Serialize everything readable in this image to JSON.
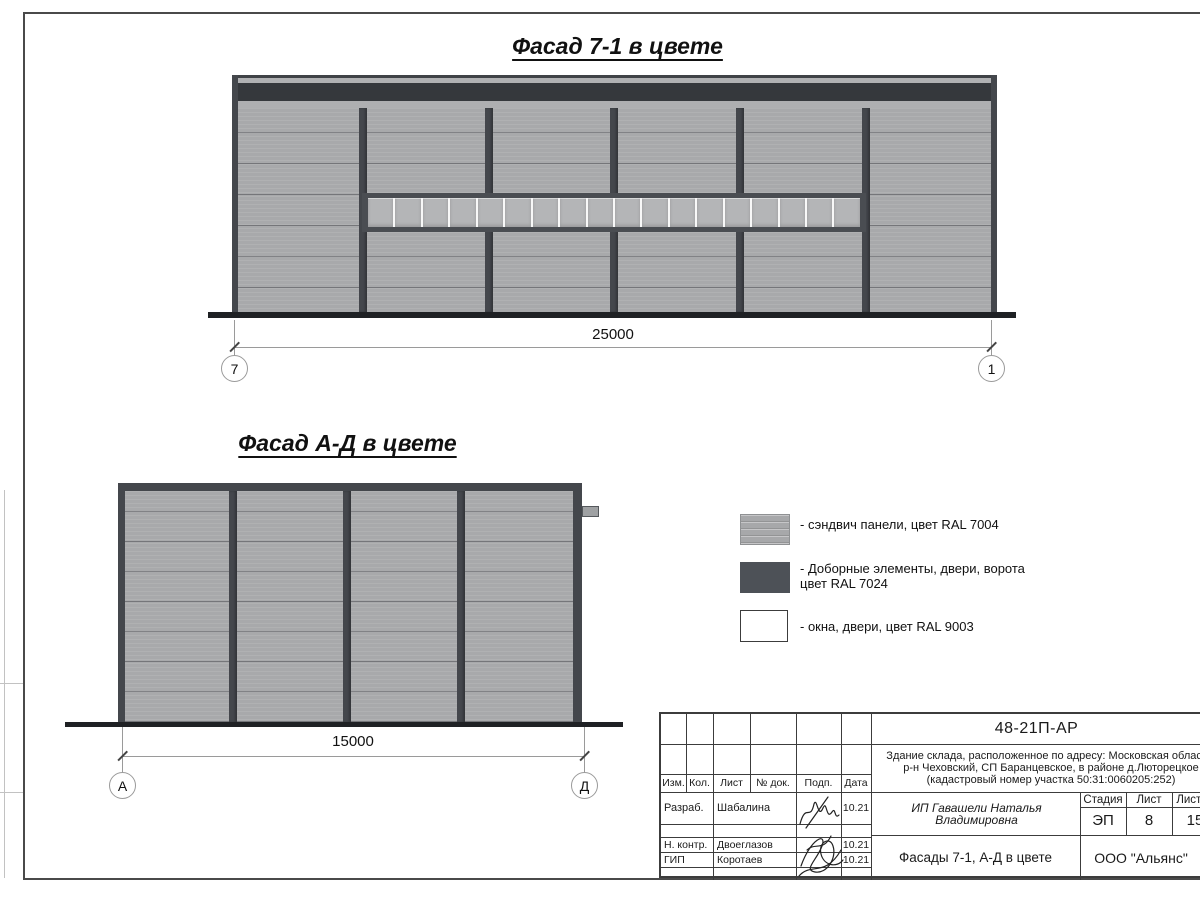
{
  "titles": {
    "facade_7_1": "Фасад 7-1 в цвете",
    "facade_ad": "Фасад А-Д в цвете"
  },
  "facade_7_1": {
    "dimension": "25000",
    "axis_left": "7",
    "axis_right": "1",
    "window_panes": 18
  },
  "facade_ad": {
    "dimension": "15000",
    "axis_left": "А",
    "axis_right": "Д"
  },
  "legend": {
    "items": [
      {
        "name": "sandwich-panels",
        "line1": "- сэндвич панели, цвет RAL 7004",
        "line2": ""
      },
      {
        "name": "trim-elements",
        "line1": "- Доборные элементы, двери, ворота",
        "line2": "цвет RAL 7024"
      },
      {
        "name": "windows-doors",
        "line1": "- окна, двери, цвет RAL 9003",
        "line2": ""
      }
    ]
  },
  "title_block": {
    "doc_number": "48-21П-АР",
    "project_line1": "Здание склада, расположенное по адресу: Московская область,",
    "project_line2": "р-н Чеховский, СП Баранцевское, в районе д.Люторецкое",
    "project_line3": "(кадастровый номер участка 50:31:0060205:252)",
    "header_cells": [
      "Изм.",
      "Кол.",
      "Лист",
      "№ док.",
      "Подп.",
      "Дата"
    ],
    "rows": [
      {
        "role": "Разраб.",
        "name": "Шабалина",
        "date": "10.21"
      },
      {
        "role": "Н. контр.",
        "name": "Двоеглазов",
        "date": "10.21"
      },
      {
        "role": "ГИП",
        "name": "Коротаев",
        "date": "10.21"
      }
    ],
    "client": "ИП Гавашели Наталья Владимировна",
    "stage_label": "Стадия",
    "sheet_label": "Лист",
    "sheets_label": "Листов",
    "stage": "ЭП",
    "sheet": "8",
    "sheets": "15",
    "doc_title": "Фасады 7-1, А-Д в цвете",
    "company": "ООО \"Альянс\""
  },
  "colors": {
    "panel": "#a8a9ab",
    "dark-trim": "#44474c",
    "parapet": "#35383c",
    "base": "#1f2124",
    "glass": "#b4b5b7",
    "mullion": "#f8f8f8"
  }
}
